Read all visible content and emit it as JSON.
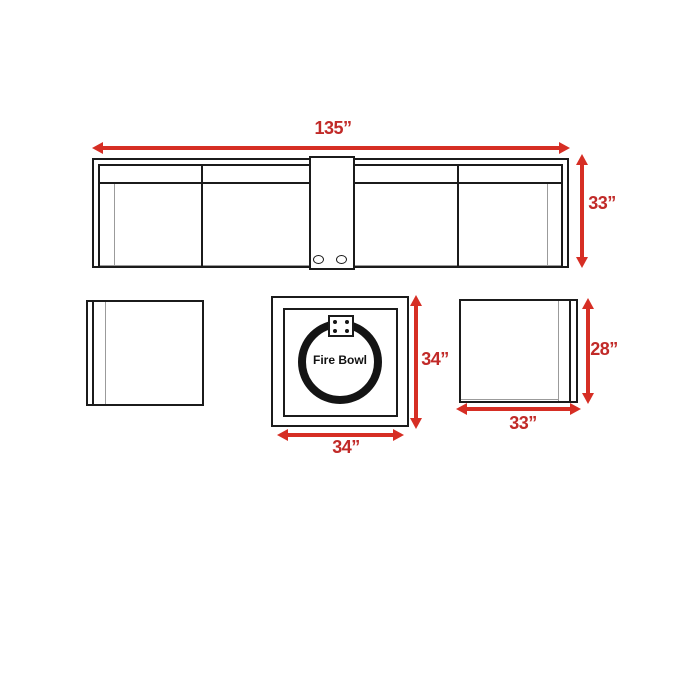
{
  "diagram": {
    "title": "patio-set-dimensions",
    "sofa": {
      "width_label": "135”",
      "depth_label": "33”"
    },
    "fire_pit_table": {
      "name": "Fire Bowl",
      "width_label": "34”",
      "depth_label": "34”"
    },
    "club_chair": {
      "width_label": "33”",
      "depth_label": "28”"
    }
  },
  "colors": {
    "arrow_red": "#d62e24",
    "label_red": "#c12a28",
    "line_dark": "#1b1b1b",
    "line_light": "#9b9b9b"
  }
}
